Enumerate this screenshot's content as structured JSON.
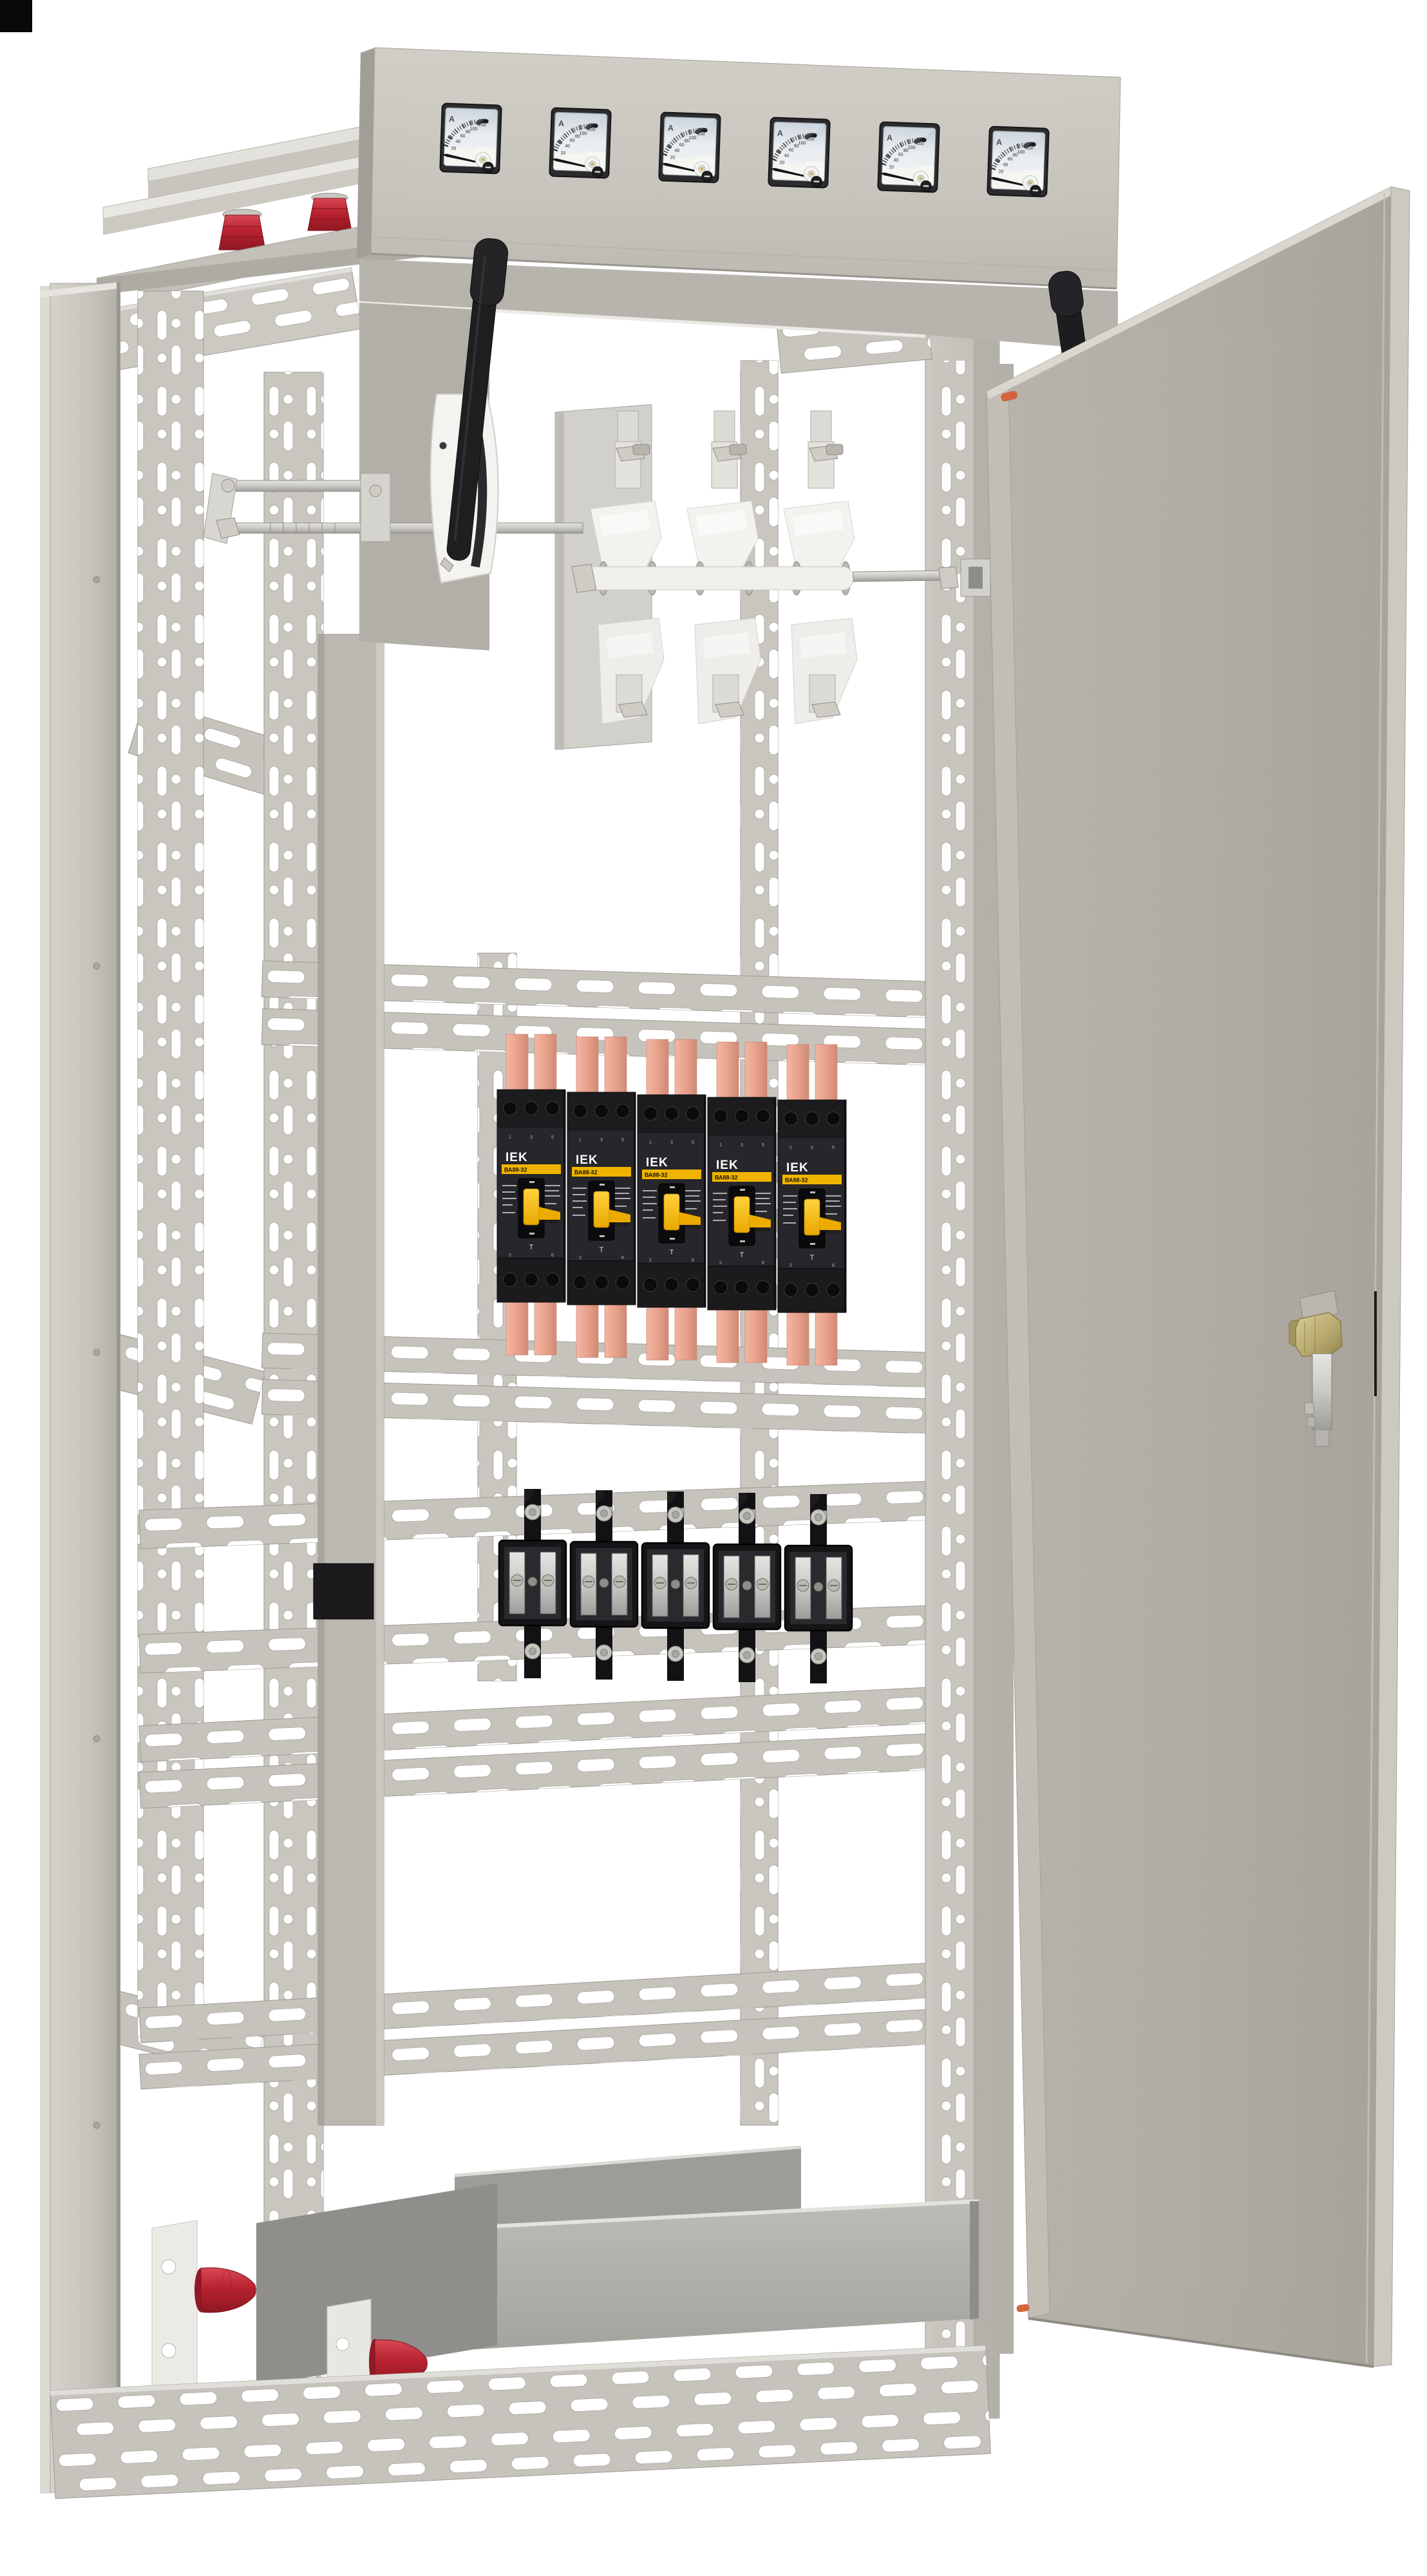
{
  "scene": {
    "subject": "Open floor-standing electrical distribution cabinet with door ajar",
    "background": "#ffffff",
    "corner_mark_color": "#07090a"
  },
  "colors": {
    "cabinet_panel": "#c9c6bf",
    "door_face": "#b3aea6",
    "door_edge": "#ccc9c1",
    "frame_post": "#c5c2bb",
    "rail": "#c6c3bc",
    "slot": "#ffffff",
    "copper_busbar": "#e8a18c",
    "insulator_red": "#b8222f",
    "breaker_body": "#212125",
    "breaker_yellow": "#f2b30a",
    "lock_brass": "#b9ab70",
    "handle_black": "#202023",
    "switch_white": "#f2f1ee"
  },
  "meter_panel": {
    "count": 6,
    "meter": {
      "unit": "A",
      "ticks": [
        "20",
        "40",
        "60",
        "80",
        "100",
        "200"
      ],
      "needle_position": "0"
    }
  },
  "main_switch": {
    "poles": 3
  },
  "breaker_row": {
    "count": 5,
    "breaker": {
      "brand": "IEK",
      "model": "ВА88-32",
      "marking": "T",
      "poles_top": [
        "1",
        "3",
        "5"
      ],
      "poles_bottom": [
        "2",
        "4",
        "6"
      ]
    }
  },
  "fuse_row": {
    "count": 5
  },
  "door": {
    "state": "open",
    "hinge_markers": 2
  }
}
